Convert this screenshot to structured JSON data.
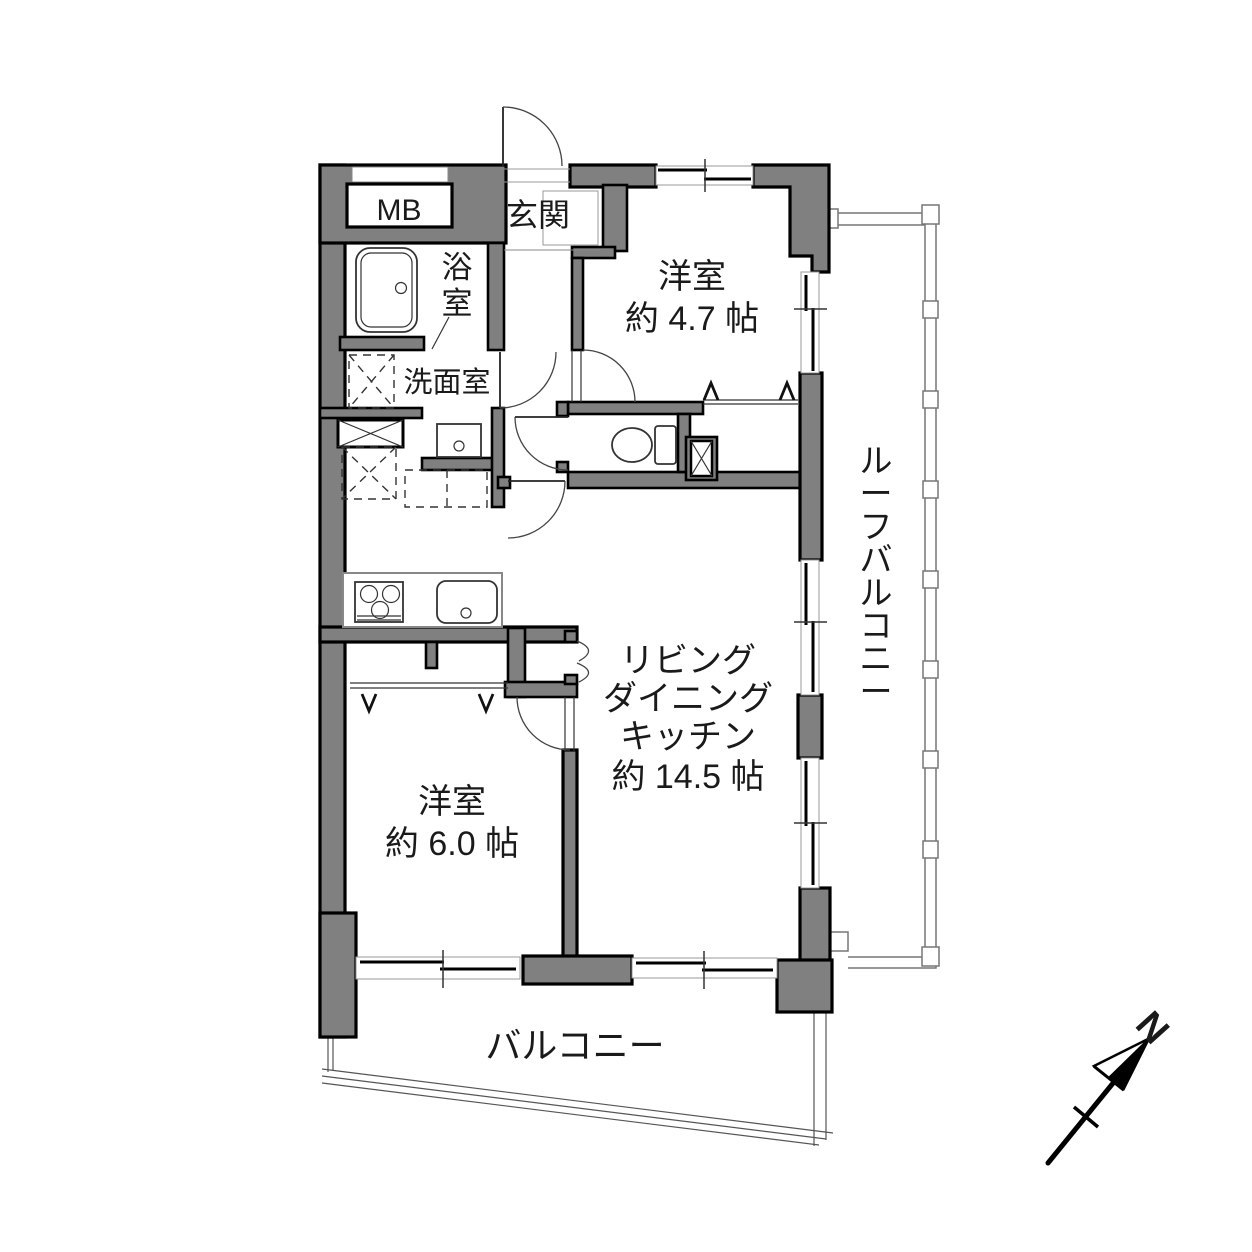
{
  "floor_plan": {
    "rooms": {
      "meter_box": {
        "label": "MB"
      },
      "entrance": {
        "label": "玄関"
      },
      "bathroom": {
        "label_vertical": "浴室"
      },
      "washroom": {
        "label": "洗面室"
      },
      "bedroom_small": {
        "name": "洋室",
        "size": "約 4.7 帖"
      },
      "bedroom_main": {
        "name": "洋室",
        "size": "約 6.0 帖"
      },
      "ldk": {
        "line1": "リビング",
        "line2": "ダイニング",
        "line3": "キッチン",
        "size": "約 14.5 帖"
      },
      "balcony": {
        "label": "バルコニー"
      },
      "roof_balcony": {
        "label_vertical": "ルーフバルコニー"
      }
    },
    "compass": {
      "north_label": "N"
    },
    "colors": {
      "background": "#ffffff",
      "wall_fill": "#808080",
      "wall_outline": "#000000",
      "thin_line": "#333333",
      "railing": "#777777"
    }
  }
}
